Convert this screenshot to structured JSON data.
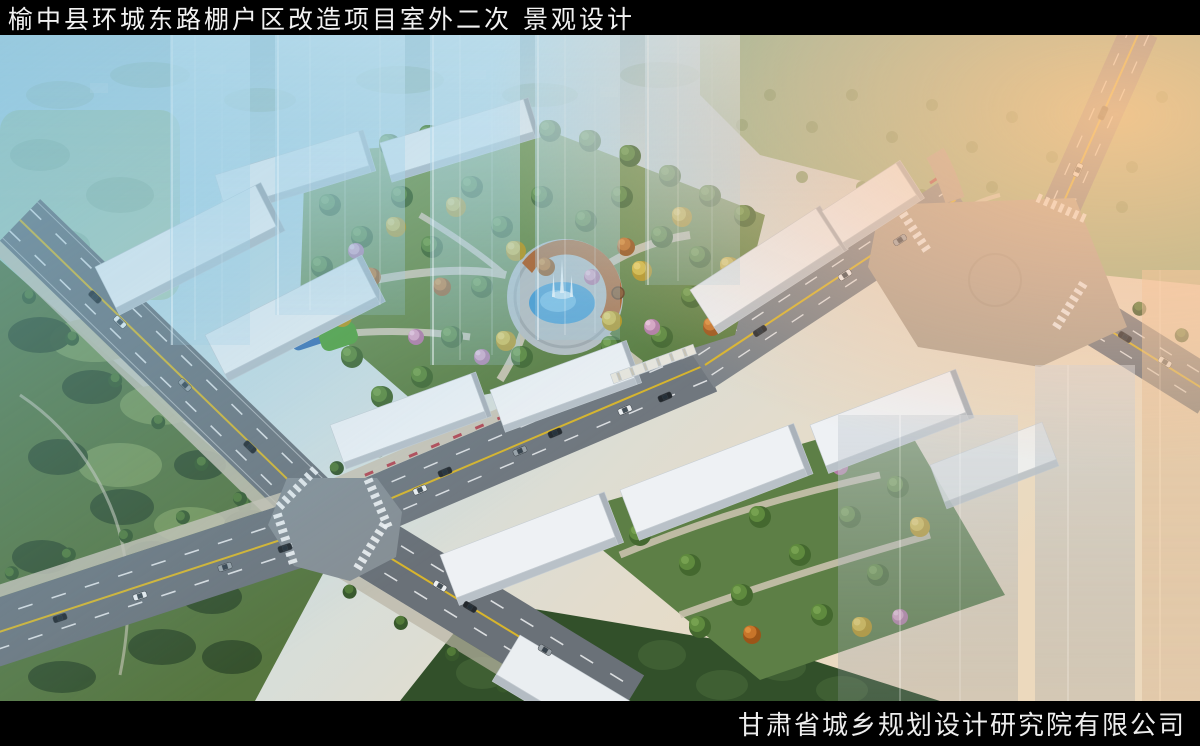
{
  "header": {
    "title": "榆中县环城东路棚户区改造项目室外二次 景观设计"
  },
  "footer": {
    "company": "甘肃省城乡规划设计研究院有限公司"
  },
  "palette": {
    "bar_black": "#000000",
    "title_white": "#f2f2f2",
    "haze_blue": "#8cc3de",
    "warm_glow": "#f7bf8e",
    "asphalt_gray": "#6e757c",
    "plaza_gray": "#b0a493",
    "building_white": "#eef1f4",
    "tree_green": "#4e7a34",
    "tree_yellow": "#e2bd3a",
    "tree_orange": "#c8752a",
    "blossom_pink": "#d9a6c6",
    "lawn_green": "#7e9c57",
    "dark_park_green": "#33502a",
    "pond_blue": "#4e9ed2",
    "pergola_rust": "#b2622a",
    "road_line_yellow": "#d8b52c"
  }
}
